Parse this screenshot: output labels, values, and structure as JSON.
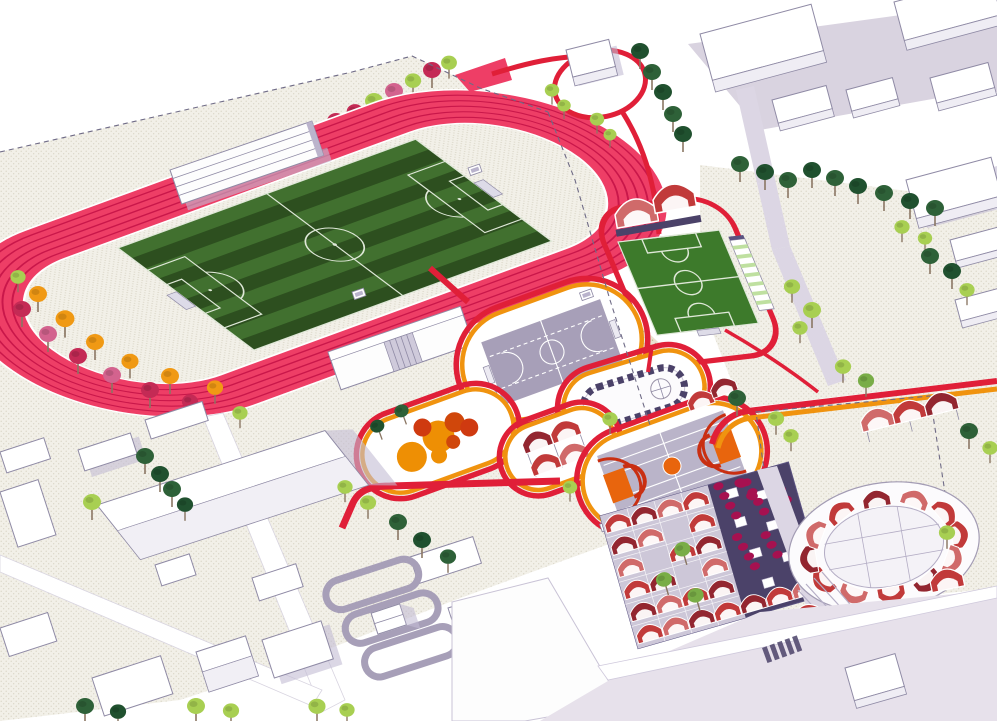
{
  "meta": {
    "kind": "architectural axonometric site-plan rendering, sports park masterplan",
    "visible_text": "none"
  },
  "scene": {
    "track_lanes": 6,
    "ringed_courts": 5,
    "market_vault_rows": 6,
    "circular_plaza_vaults": 12
  },
  "colors": {
    "plazaBase": "#f2f0e8",
    "plazaDot": "#d6d2c2",
    "gravelBase": "#eae2cf",
    "gravelDot": "#c2b493",
    "trackPink": "#ee3e66",
    "trackLane": "#c9174a",
    "pathRed": "#e01f38",
    "ringOrange": "#f0930f",
    "grassLight": "#41702f",
    "grassDark": "#2d4f1f",
    "fieldLine": "#dfe8d8",
    "smallField": "#3d7a2b",
    "courtGray": "#a79fb8",
    "bballGray": "#bab4c9",
    "bballOrange": "#e8650d",
    "bballRed": "#c92f12",
    "playOrange": "#ee8f04",
    "playDark": "#d0470b",
    "playRed": "#cf3a10",
    "navy": "#4b4269",
    "navyLight": "#5a5280",
    "vaultRed": "#c13a3a",
    "vaultDark": "#932630",
    "vaultLight": "#d06a6a",
    "buildingStroke": "#8f8aa5",
    "roofLav": "#d6d0e0",
    "shadowLav": "#c3bdd3",
    "lavArea": "#d9d3e0",
    "pathLav": "#dcd6e4",
    "roadLav": "#e7e1eb",
    "treeLightGreen": "#a8cf52",
    "treeGreen": "#79ad47",
    "treeDark": "#2e6138",
    "treeDarker": "#20512f",
    "treeCrimson": "#c42a55",
    "treePink": "#d3638e",
    "treeOrange": "#f09914",
    "bushMagenta": "#a61150",
    "trunk": "#8a7663",
    "dashLine": "#6f6b86"
  }
}
